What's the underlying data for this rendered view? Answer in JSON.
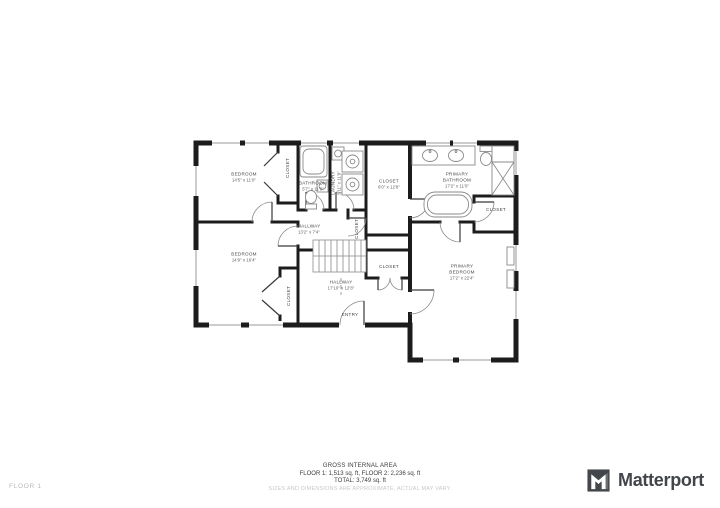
{
  "plan": {
    "wall_color": "#1c1c1c",
    "rooms": [
      {
        "name": "BEDROOM",
        "dims": "14'5\" x 11'0\""
      },
      {
        "name": "CLOSET",
        "dims": ""
      },
      {
        "name": "BATHROOM",
        "dims": "5'7\" x 11'0\""
      },
      {
        "name": "LAUNDRY",
        "dims": "5'11\" x 11'9\""
      },
      {
        "name": "CLOSET",
        "dims": "6'0\" x 12'8\""
      },
      {
        "name": "PRIMARY BATHROOM",
        "dims": "17'2\" x 11'0\""
      },
      {
        "name": "CLOSET",
        "dims": ""
      },
      {
        "name": "HALLWAY",
        "dims": "13'2\" x 7'4\""
      },
      {
        "name": "CLOSET",
        "dims": ""
      },
      {
        "name": "BEDROOM",
        "dims": "14'9\" x 16'4\""
      },
      {
        "name": "CLOSET",
        "dims": ""
      },
      {
        "name": "HALLWAY",
        "dims": "17'10\" x 12'8\""
      },
      {
        "name": "CLOSET",
        "dims": ""
      },
      {
        "name": "ENTRY",
        "dims": ""
      },
      {
        "name": "PRIMARY BEDROOM",
        "dims": "17'2\" x 22'4\""
      }
    ]
  },
  "footer": {
    "area_title": "GROSS INTERNAL AREA",
    "area_floors": "FLOOR 1: 1,513 sq. ft, FLOOR 2: 2,236 sq. ft",
    "area_total": "TOTAL: 3,749 sq. ft",
    "disclaimer": "SIZES AND DIMENSIONS ARE APPROXIMATE, ACTUAL MAY VARY.",
    "floor_label": "FLOOR 1"
  },
  "branding": {
    "logo_text": "Matterport"
  }
}
